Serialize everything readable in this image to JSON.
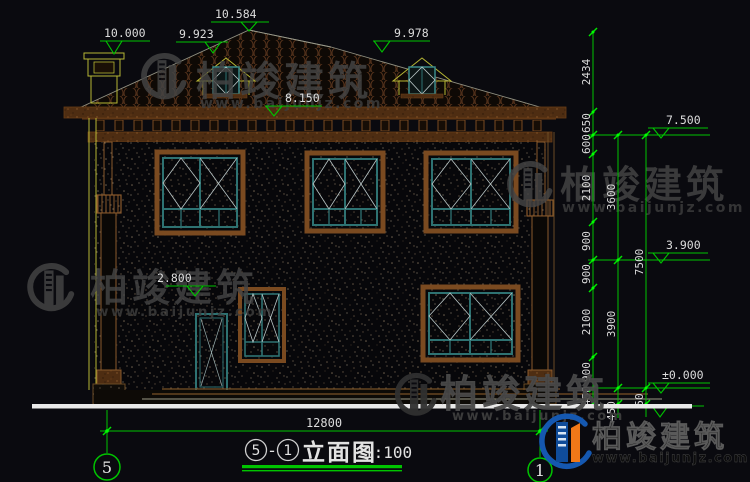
{
  "drawing": {
    "title": {
      "axis_left": "5",
      "separator": "-",
      "axis_right": "1",
      "name": "立面图",
      "scale": "1:100"
    },
    "axis_bubbles": {
      "left": "5",
      "right": "1"
    },
    "top_elevations": {
      "chimney": "10.000",
      "dormer_left": "9.923",
      "ridge": "10.584",
      "dormer_right": "9.978",
      "eave": "8.150",
      "porch": "2.800"
    },
    "right_elevations": {
      "upper": "7.500",
      "middle": "3.900",
      "zero": "±0.000"
    },
    "dims": {
      "col1": [
        "2434",
        "650",
        "600",
        "2100",
        "900",
        "900",
        "2100",
        "900",
        "450"
      ],
      "col2": [
        "3600",
        "3900",
        "450"
      ],
      "col3": [
        "7500",
        "50"
      ],
      "bottom_total": "12800"
    }
  },
  "watermark": {
    "brand": "柏竣建筑",
    "url": "www.baijunjz.com"
  },
  "logo": {
    "brand": "柏竣建筑",
    "url": "www.baijunjz.com"
  },
  "colors": {
    "dim_green": "#00c400",
    "text_white": "#dcdcdc",
    "frame_teal": "#2e7272",
    "frame_brown": "#7a4a20",
    "outline_yellow": "#b6b634",
    "logo_blue": "#1456aa",
    "logo_orange": "#f07818"
  }
}
